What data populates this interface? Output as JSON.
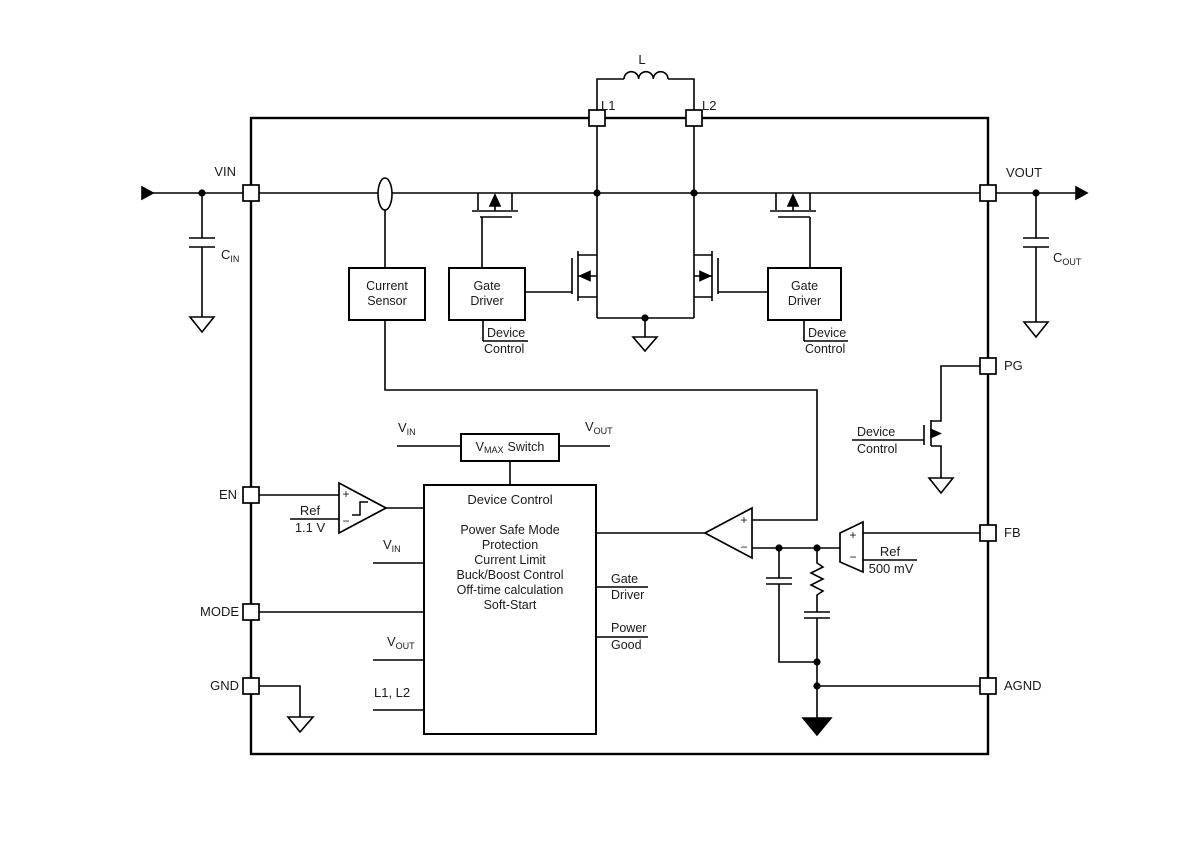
{
  "pins": {
    "vin": "VIN",
    "vout": "VOUT",
    "l1": "L1",
    "l2": "L2",
    "pg": "PG",
    "fb": "FB",
    "agnd": "AGND",
    "en": "EN",
    "mode": "MODE",
    "gnd": "GND"
  },
  "components": {
    "inductor_label": "L",
    "cin": {
      "name": "C",
      "sub": "IN"
    },
    "cout": {
      "name": "C",
      "sub": "OUT"
    }
  },
  "blocks": {
    "current_sensor": [
      "Current",
      "Sensor"
    ],
    "gate_driver": [
      "Gate",
      "Driver"
    ],
    "vmax_switch": {
      "v": "V",
      "sub": "MAX",
      "rest": "Switch"
    },
    "device_control": {
      "title": "Device Control",
      "functions": [
        "Power Safe Mode",
        "Protection",
        "Current Limit",
        "Buck/Boost Control",
        "Off-time calculation",
        "Soft-Start"
      ]
    }
  },
  "tags": {
    "device_control": [
      "Device",
      "Control"
    ],
    "gate_driver": [
      "Gate",
      "Driver"
    ],
    "power_good": [
      "Power",
      "Good"
    ]
  },
  "signals": {
    "vin": {
      "name": "V",
      "sub": "IN"
    },
    "vout": {
      "name": "V",
      "sub": "OUT"
    },
    "l1l2": "L1, L2",
    "ref_en": {
      "top": "Ref",
      "bottom": "1.1 V"
    },
    "ref_fb": {
      "top": "Ref",
      "bottom": "500 mV"
    }
  },
  "opamp": {
    "plus": "+",
    "minus": "−"
  },
  "colors": {
    "line": "#000000",
    "text": "#1a1a1a",
    "background": "#ffffff"
  }
}
